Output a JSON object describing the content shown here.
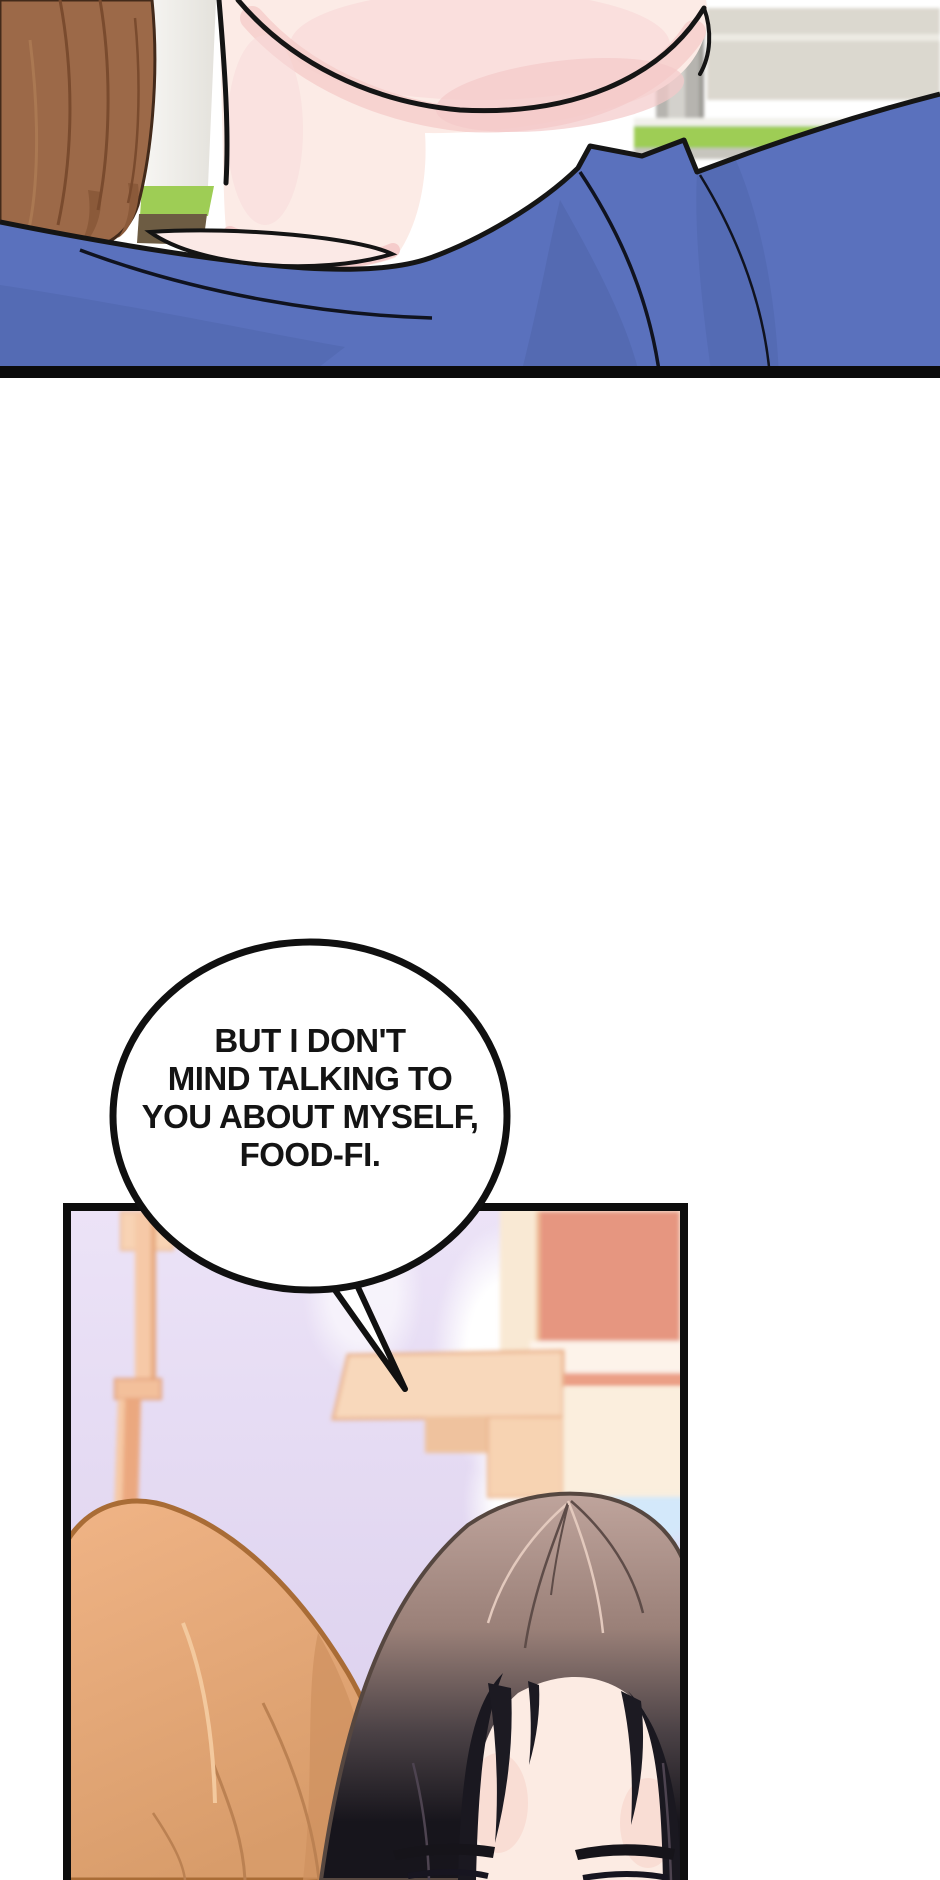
{
  "speech_bubble": {
    "lines": [
      "BUT I DON'T",
      "MIND TALKING TO",
      "YOU ABOUT MYSELF,",
      "FOOD-FI."
    ]
  },
  "palette": {
    "shirt_blue": "#5a71bd",
    "shirt_shadow_blue": "#4d63a8",
    "hair_brown_top_panel": "#9c6948",
    "hair_orange_left_head": "#e8ab7c",
    "hair_dark_right_head": "#1a1820",
    "hair_mauve_right_head": "#bfa49c",
    "skin": "#fcebe6",
    "blush_pink": "#f5cdcb",
    "sky_lavender": "#ece3f7",
    "sky_blue_patch": "#d3e8fa",
    "window_salmon": "#e69680",
    "beam_peach": "#f8d8bb",
    "grass_green": "#9ecd55",
    "wall_beige": "#dbd8cf",
    "pole_grey": "#b6b4af",
    "panel_border_black": "#0d0d0d",
    "bubble_fill": "#ffffff",
    "bubble_stroke": "#101010"
  }
}
